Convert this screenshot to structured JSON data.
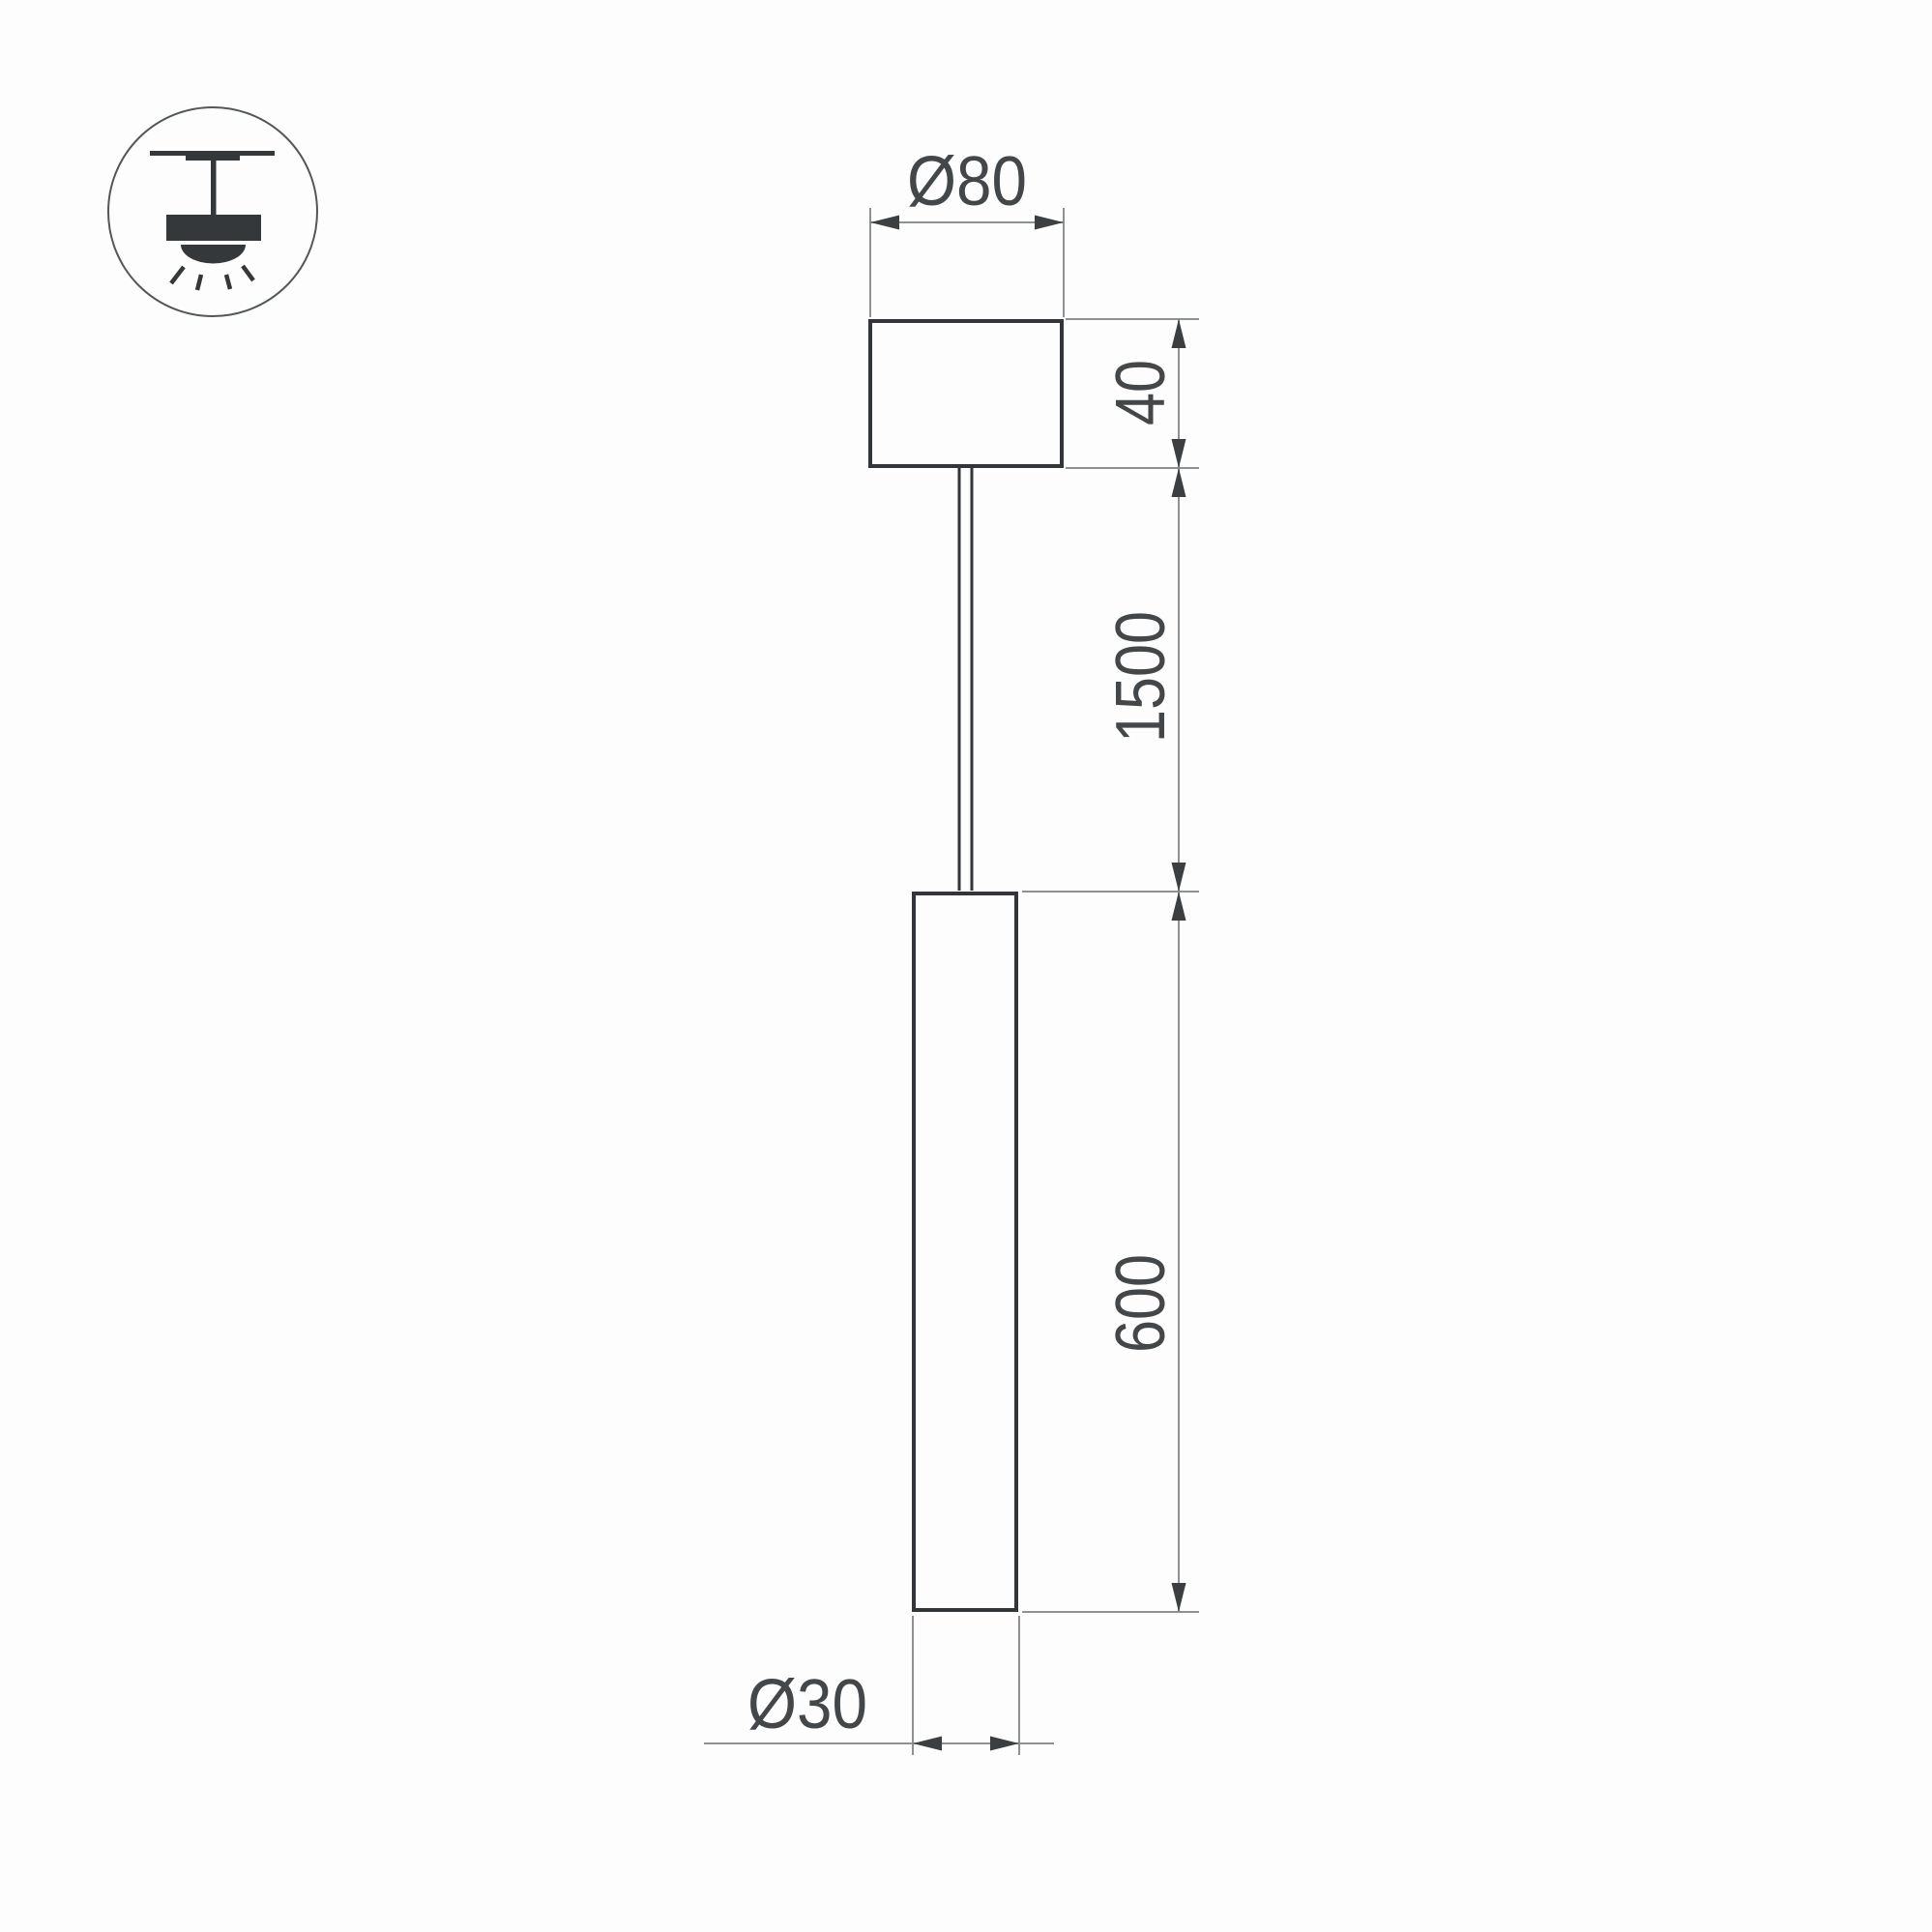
{
  "drawing": {
    "type": "technical dimension drawing of pendant luminaire",
    "icon": {
      "name": "pendant-ceiling-light-icon"
    },
    "dimensions": {
      "canopy_diameter": {
        "label": "Ø80",
        "value": 80
      },
      "canopy_height": {
        "label": "40",
        "value": 40
      },
      "suspension_length": {
        "label": "1500",
        "value": 1500
      },
      "tube_length": {
        "label": "600",
        "value": 600
      },
      "tube_diameter": {
        "label": "Ø30",
        "value": 30
      }
    },
    "colors": {
      "background": "#fdfdfd",
      "fixture_outline": "#323539",
      "dimension_lines": "#8e9092",
      "dimension_text": "#44474a",
      "icon_fill": "#35383b"
    }
  }
}
